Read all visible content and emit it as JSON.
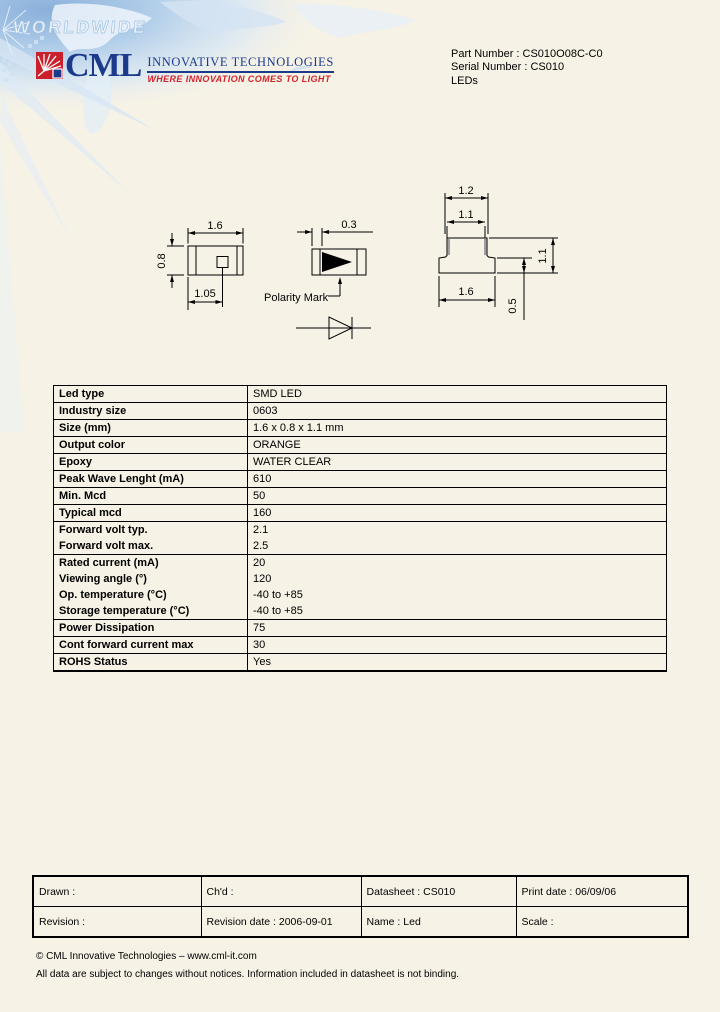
{
  "colors": {
    "page_bg": "#f6f2e6",
    "brand_blue": "#1b3a8c",
    "brand_red": "#c9202b",
    "map_blue": "#8ab0da",
    "line_black": "#000000"
  },
  "header": {
    "watermark": "WORLDWIDE",
    "logo_text": "CML",
    "logo_line1": "INNOVATIVE TECHNOLOGIES",
    "logo_line2": "WHERE INNOVATION COMES TO LIGHT",
    "part_number": "Part Number : CS010O08C-C0",
    "serial_number": "Serial Number : CS010",
    "category": "LEDs"
  },
  "drawings": {
    "top_view": {
      "width": "1.6",
      "height": "0.8",
      "pad": "1.05"
    },
    "front_view": {
      "pad_width": "0.3",
      "polarity_label": "Polarity Mark"
    },
    "side_view": {
      "top_width": "1.2",
      "inner_width": "1.1",
      "bottom_width": "1.6",
      "height": "1.1",
      "base_height": "0.5"
    }
  },
  "spec_table": {
    "rows": [
      {
        "label": "Led type",
        "value": "SMD LED"
      },
      {
        "label": "Industry size",
        "value": "0603"
      },
      {
        "label": "Size (mm)",
        "value": "1.6 x 0.8 x 1.1 mm"
      },
      {
        "label": "Output color",
        "value": "ORANGE"
      },
      {
        "label": "Epoxy",
        "value": "WATER CLEAR"
      },
      {
        "label": "Peak Wave Lenght (mA)",
        "value": "610"
      },
      {
        "label": "Min. Mcd",
        "value": "50"
      },
      {
        "label": "Typical mcd",
        "value": "160"
      },
      {
        "label": "Forward volt typ.",
        "value": "2.1"
      },
      {
        "label": "Forward volt max.",
        "value": "2.5"
      },
      {
        "label": "Rated current (mA)",
        "value": "20"
      },
      {
        "label": "Viewing angle (°)",
        "value": "120"
      },
      {
        "label": "Op. temperature (°C)",
        "value": "-40 to +85"
      },
      {
        "label": "Storage temperature (°C)",
        "value": "-40 to +85"
      },
      {
        "label": "Power Dissipation",
        "value": "75"
      },
      {
        "label": "Cont forward current max",
        "value": "30"
      },
      {
        "label": "ROHS Status",
        "value": "Yes"
      }
    ]
  },
  "footer_table": {
    "rows": [
      [
        "Drawn :",
        "Ch'd :",
        "Datasheet : CS010",
        "Print date : 06/09/06"
      ],
      [
        "Revision :",
        "Revision date : 2006-09-01",
        "Name : Led",
        "Scale :"
      ]
    ]
  },
  "footer": {
    "line1": "© CML Innovative Technologies – www.cml-it.com",
    "line2": "All data are subject to changes without notices. Information included in datasheet is not binding."
  }
}
